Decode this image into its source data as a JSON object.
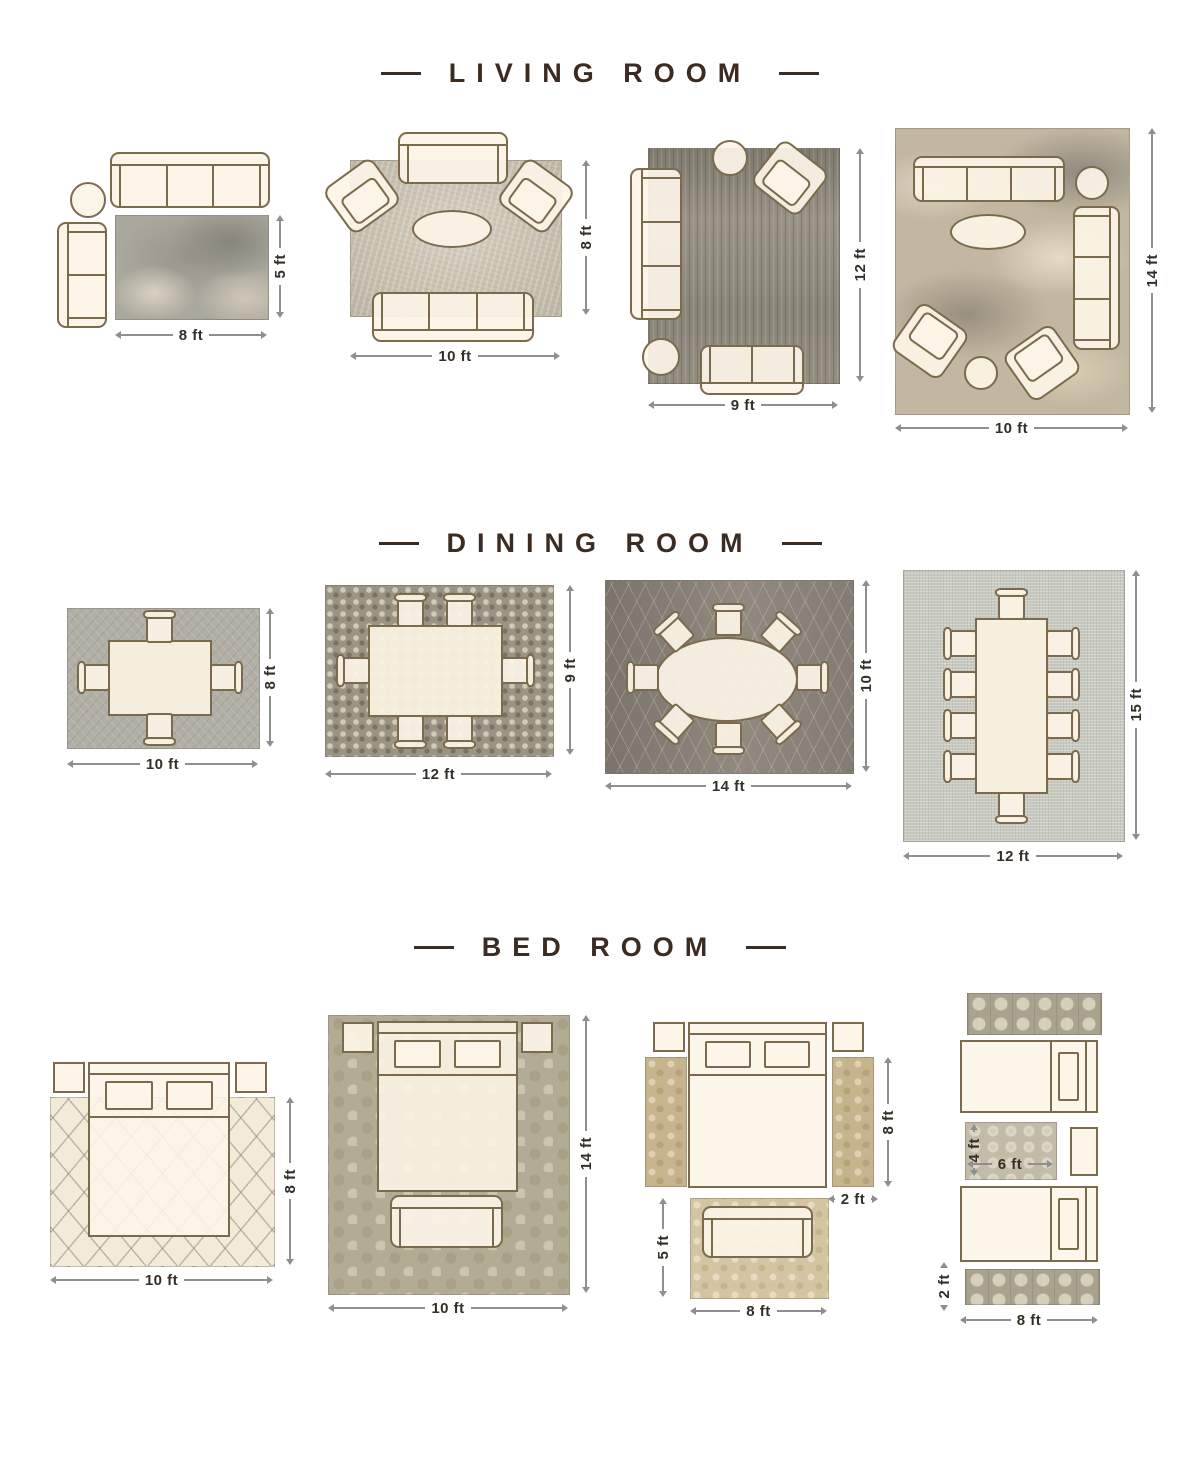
{
  "palette": {
    "title_color": "#3c2b20",
    "furniture_outline": "#7c6a4d",
    "furniture_fill": "#fcf4e6",
    "dimension_line": "#8f8f8f",
    "dimension_text": "#342e26"
  },
  "sections": [
    {
      "title": "LIVING ROOM",
      "layouts": [
        {
          "width": "8 ft",
          "height": "5 ft"
        },
        {
          "width": "10 ft",
          "height": "8 ft"
        },
        {
          "width": "9 ft",
          "height": "12 ft"
        },
        {
          "width": "10 ft",
          "height": "14 ft"
        }
      ]
    },
    {
      "title": "DINING ROOM",
      "layouts": [
        {
          "width": "10 ft",
          "height": "8 ft"
        },
        {
          "width": "12 ft",
          "height": "9 ft"
        },
        {
          "width": "14 ft",
          "height": "10 ft"
        },
        {
          "width": "12 ft",
          "height": "15 ft"
        }
      ]
    },
    {
      "title": "BED ROOM",
      "layouts": [
        {
          "width": "10 ft",
          "height": "8 ft"
        },
        {
          "width": "10 ft",
          "height": "14 ft"
        },
        {
          "runner_height": "8 ft",
          "runner_width": "2 ft",
          "rug_height": "5 ft",
          "rug_width": "8 ft"
        },
        {
          "mid_rug_height": "4 ft",
          "mid_rug_width": "6 ft",
          "runner_height": "2 ft",
          "runner_width": "8 ft"
        }
      ]
    }
  ]
}
